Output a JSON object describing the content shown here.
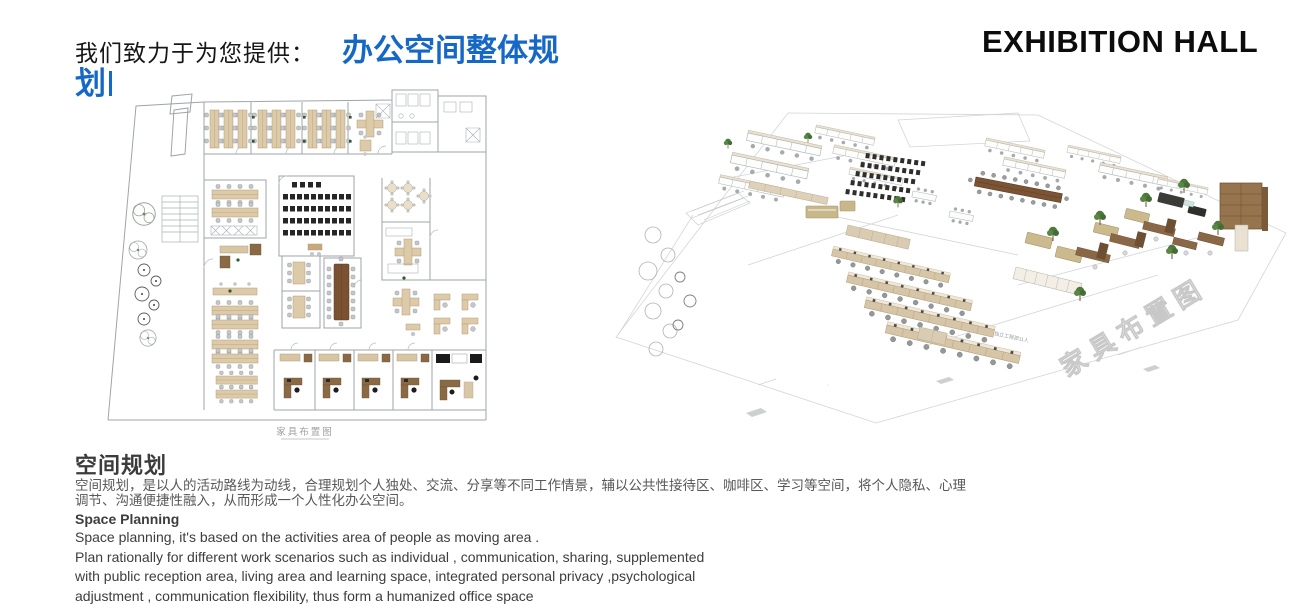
{
  "header": {
    "lead_text": "我们致力于为您提供：",
    "highlight_line1": "办公空间整体规",
    "highlight_line2": "划",
    "highlight_color": "#1568c6",
    "right_title": "EXHIBITION HALL"
  },
  "floorplan": {
    "caption": "家具布置图"
  },
  "render3d": {
    "watermark": "家具布置图",
    "area_label": "独立工程部11人"
  },
  "body": {
    "cn_heading": "空间规划",
    "cn_lines": [
      "空间规划，是以人的活动路线为动线，合理规划个人独处、交流、分享等不同工作情景，辅以公共性接待区、咖啡区、学习等空间，将个人隐私、心理",
      "调节、沟通便捷性融入，从而形成一个人性化办公空间。"
    ],
    "en_heading": "Space Planning",
    "en_lines": [
      "Space planning, it's based on the activities area of people as moving area .",
      "Plan rationally for different work scenarios such as individual , communication, sharing, supplemented",
      "with public reception area, living area and learning space, integrated personal privacy ,psychological",
      "adjustment , communication flexibility, thus form a humanized office space"
    ]
  },
  "colors": {
    "accent_blue": "#1568c6",
    "title_black": "#0c0c0c",
    "body_gray": "#585858",
    "desk_tan": "#dccaa9",
    "wood_brown": "#7a5231",
    "cad_line": "#9fa4a8"
  }
}
